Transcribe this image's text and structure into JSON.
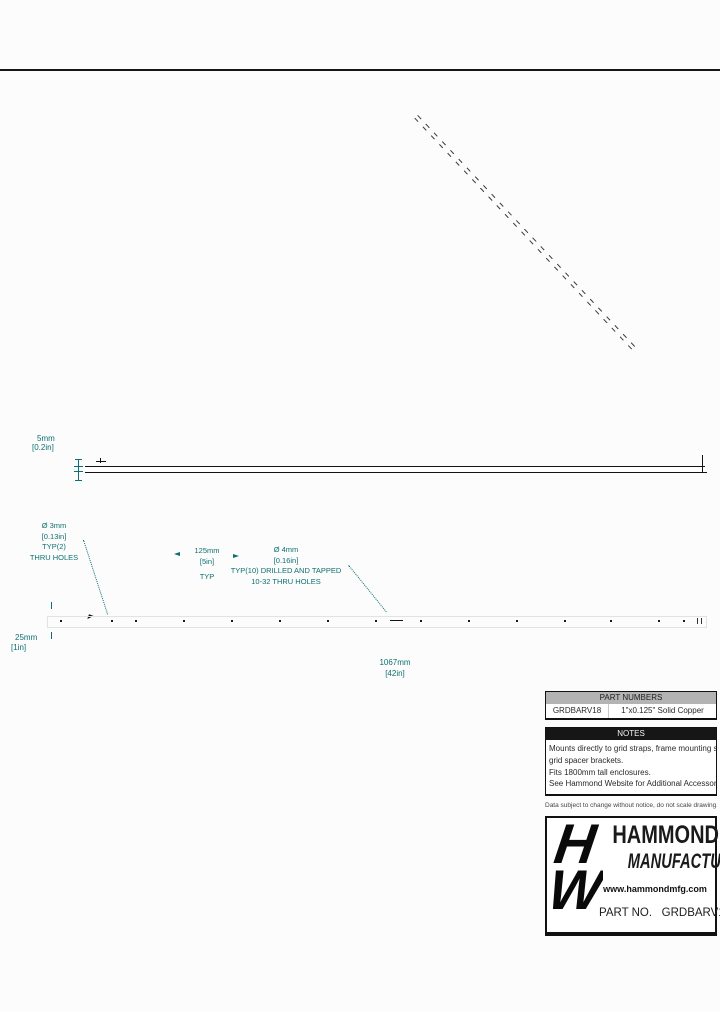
{
  "annotations": {
    "thickness_mm": "5mm",
    "thickness_in": "[0.2in]",
    "hole3_dia": "Ø 3mm",
    "hole3_in": "[0.13in]",
    "hole3_typ": "TYP(2)",
    "hole3_desc": "THRU HOLES",
    "pitch_mm": "125mm",
    "pitch_in": "[5in]",
    "pitch_typ": "TYP",
    "hole4_dia": "Ø 4mm",
    "hole4_in": "[0.16in]",
    "hole4_typ": "TYP(10) DRILLED AND TAPPED",
    "hole4_desc": "10-32 THRU HOLES",
    "offset_mm": "25mm",
    "offset_in": "[1in]",
    "length_mm": "1067mm",
    "length_in": "[42in]"
  },
  "part_numbers": {
    "header": "PART NUMBERS",
    "rows": [
      {
        "part": "GRDBARV18",
        "description": "1\"x0.125\" Solid Copper"
      }
    ]
  },
  "notes": {
    "header": "NOTES",
    "lines": [
      "Mounts directly to grid straps, frame mounting surface, or optional",
      "grid spacer brackets.",
      "Fits 1800mm tall enclosures.",
      "See Hammond Website for Additional Accessories"
    ]
  },
  "disclaimer": "Data subject to change without notice, do not scale drawing, not to scale.",
  "title_block": {
    "logo_top": "H",
    "logo_bottom": "W",
    "company_line1": "HAMMOND",
    "company_line2": "MANUFACTURING",
    "trademark": "™",
    "website": "www.hammondmfg.com",
    "part_label": "PART NO.",
    "part_number": "GRDBARV18"
  },
  "colors": {
    "dimension_teal": "#0d6f6f",
    "part_header_bg": "#b3b3b3",
    "notes_header_bg": "#161616",
    "line_black": "#141414"
  }
}
